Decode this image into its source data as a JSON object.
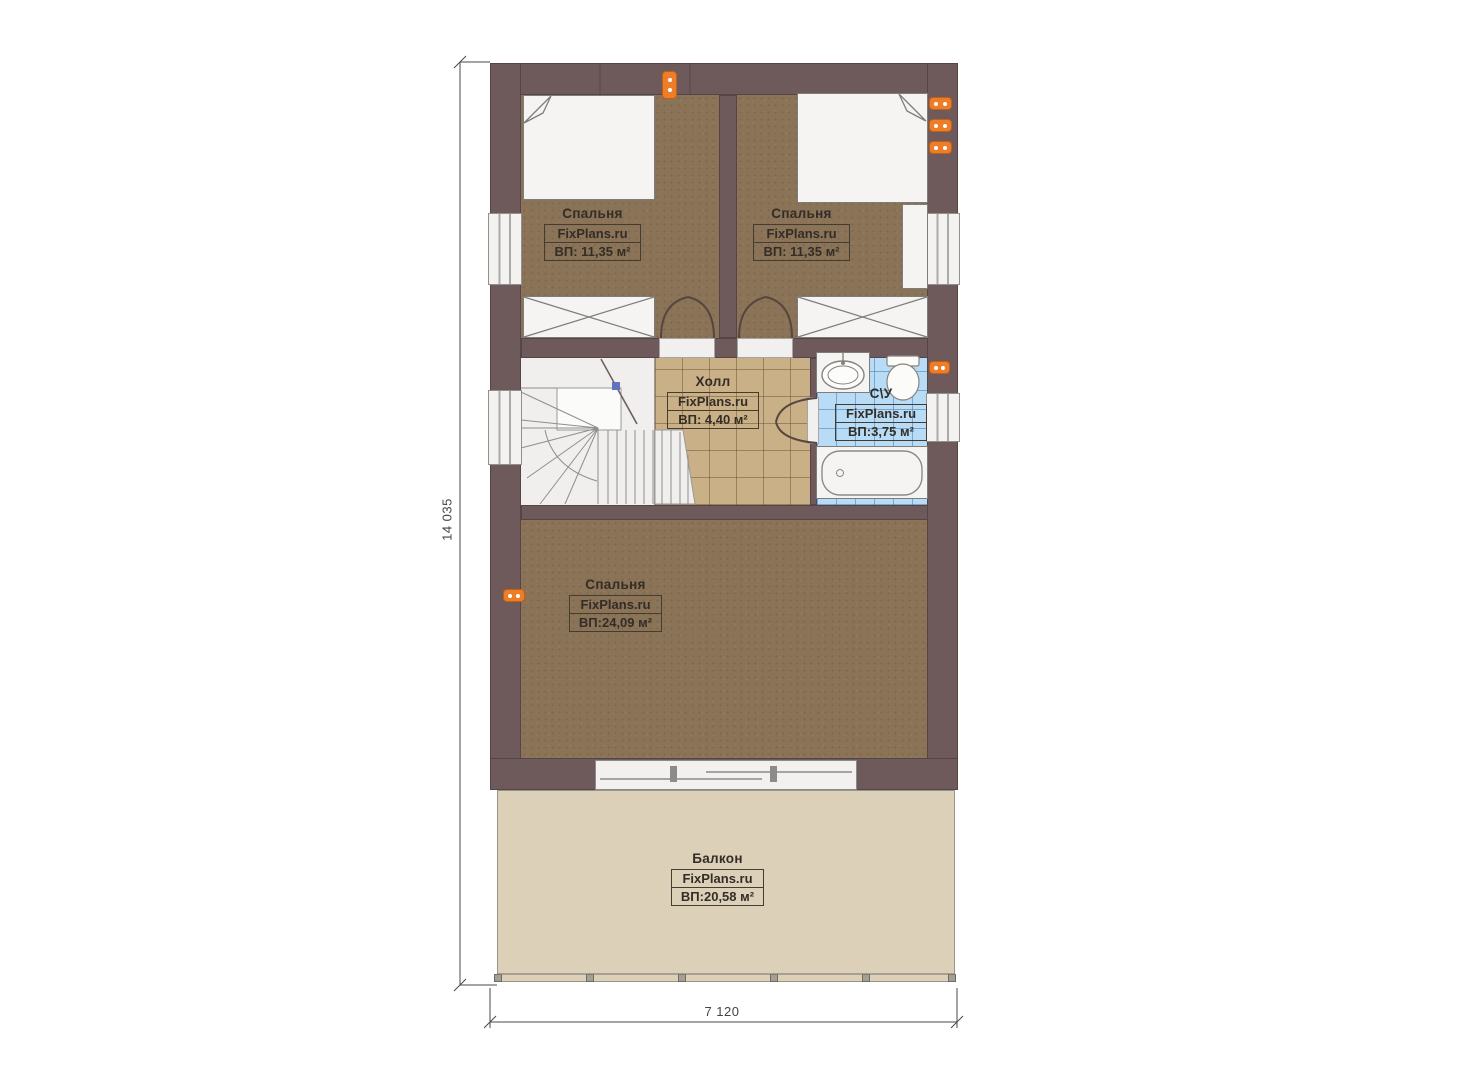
{
  "plan": {
    "rooms": [
      {
        "name": "Спальня",
        "brand": "FixPlans.ru",
        "area": "ВП: 11,35 м²"
      },
      {
        "name": "Спальня",
        "brand": "FixPlans.ru",
        "area": "ВП: 11,35 м²"
      },
      {
        "name": "Холл",
        "brand": "FixPlans.ru",
        "area": "ВП: 4,40 м²"
      },
      {
        "name": "С\\У",
        "brand": "FixPlans.ru",
        "area": "ВП:3,75 м²"
      },
      {
        "name": "Спальня",
        "brand": "FixPlans.ru",
        "area": "ВП:24,09 м²"
      },
      {
        "name": "Балкон",
        "brand": "FixPlans.ru",
        "area": "ВП:20,58 м²"
      }
    ],
    "dimensions": {
      "vertical": "14 035",
      "horizontal": "7 120"
    },
    "colors": {
      "wall": "#6e5a5b",
      "carpet": "#8a7356",
      "hall_tile": "#c9b087",
      "bath_tile": "#b8dcf5",
      "balcony": "#ddd0b9",
      "outlet_orange": "#ee7d2a"
    }
  }
}
